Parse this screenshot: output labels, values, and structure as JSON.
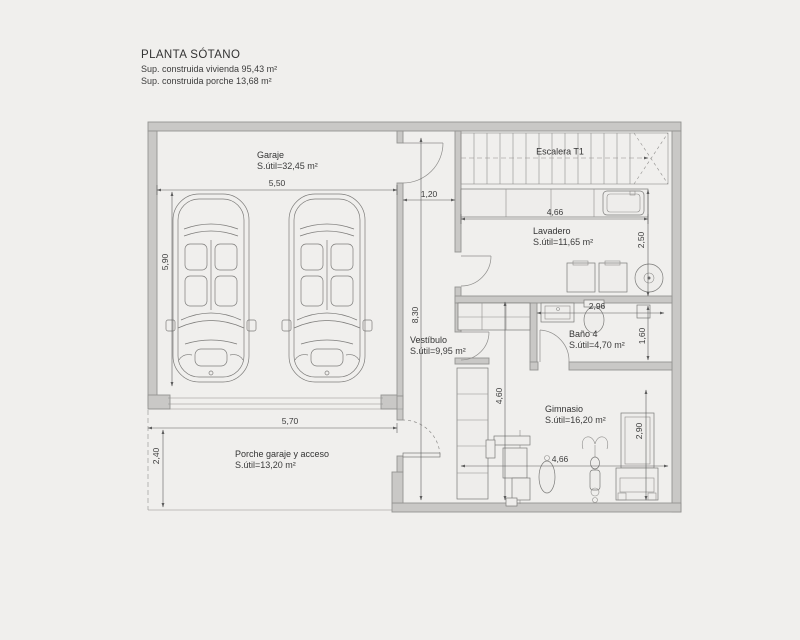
{
  "title_block": {
    "title": "PLANTA SÓTANO",
    "surface_line1": "Sup. construida vivienda 95,43 m²",
    "surface_line2": "Sup. construida porche 13,68 m²"
  },
  "rooms": {
    "garaje": {
      "name": "Garaje",
      "area": "S.útil=32,45 m²"
    },
    "escalera": {
      "name": "Escalera T1"
    },
    "lavadero": {
      "name": "Lavadero",
      "area": "S.útil=11,65 m²"
    },
    "vestibulo": {
      "name": "Vestíbulo",
      "area": "S.útil=9,95 m²"
    },
    "bano4": {
      "name": "Baño 4",
      "area": "S.útil=4,70 m²"
    },
    "gimnasio": {
      "name": "Gimnasio",
      "area": "S.útil=16,20 m²"
    },
    "porche": {
      "name": "Porche garaje y acceso",
      "area": "S.útil=13,20 m²"
    }
  },
  "dimensions": {
    "garaje_width": "5,50",
    "garaje_depth": "5,90",
    "pasillo_width": "1,20",
    "pasillo_length": "8,30",
    "lavadero_width": "4,66",
    "lavadero_depth": "2,50",
    "bano_width": "2,96",
    "bano_depth": "1,60",
    "gimnasio_length": "4,60",
    "gimnasio_width": "4,66",
    "gimnasio_depth": "2,90",
    "porche_width": "5,70",
    "porche_depth": "2,40"
  },
  "colors": {
    "background": "#f0efed",
    "wall_fill": "#c9c8c6",
    "line": "#6e6e6e",
    "dim_line": "#5c5c5c",
    "text": "#3c3c3c"
  }
}
